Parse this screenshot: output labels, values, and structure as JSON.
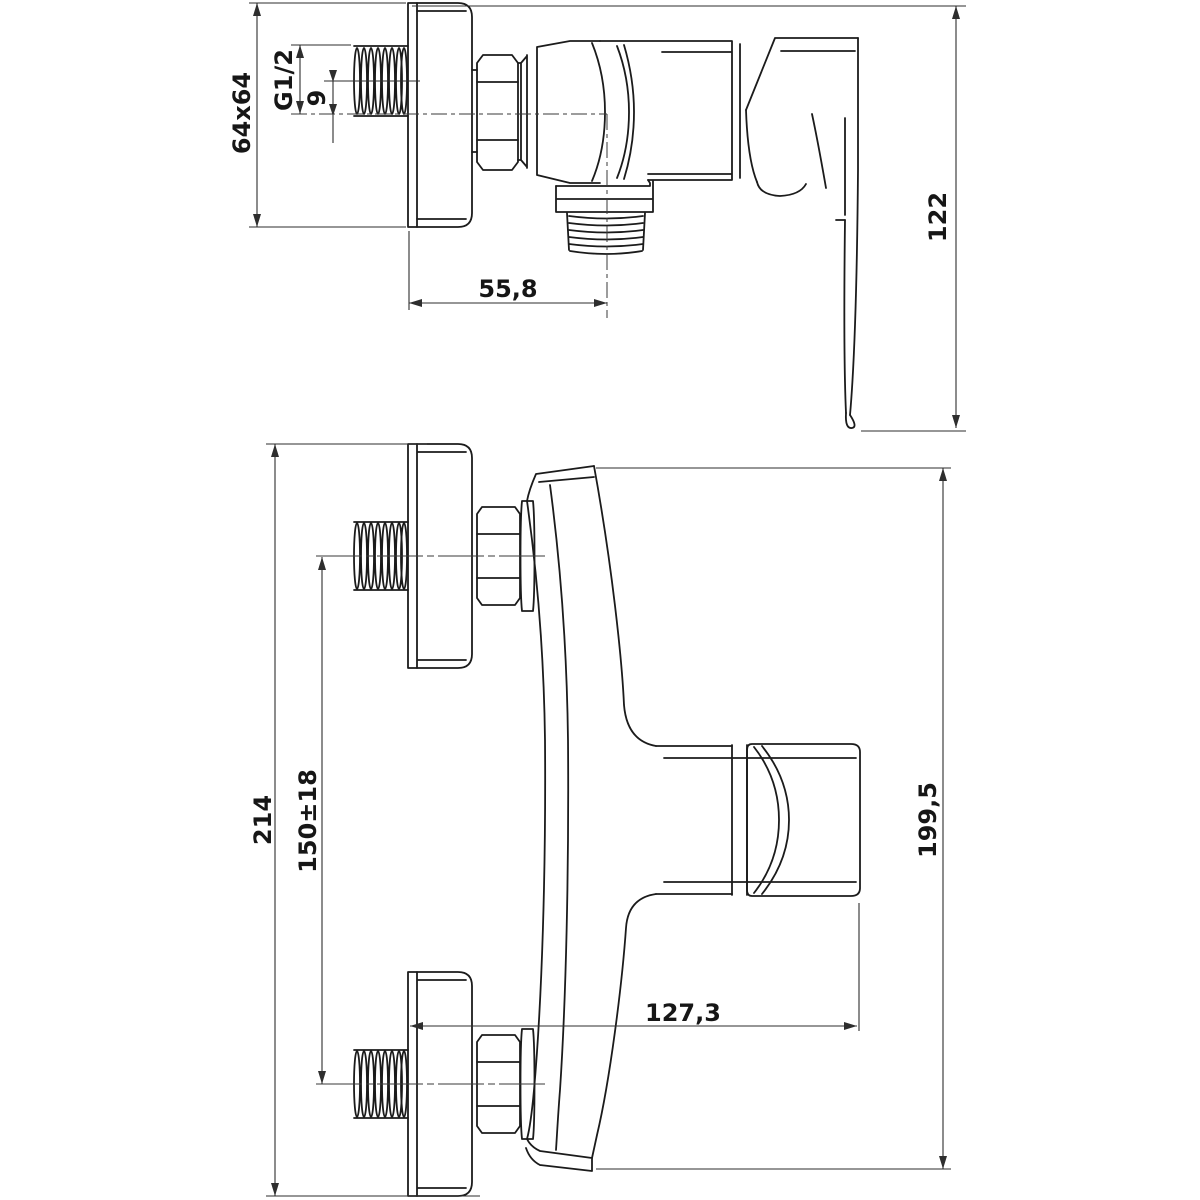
{
  "drawing": {
    "kind": "technical-dimension-drawing",
    "subject": "wall-mounted single-lever shower mixer tap, two orthographic views",
    "colors": {
      "background": "#ffffff",
      "line": "#1b1b1b",
      "dim_line": "#2e2e2e",
      "text": "#161616"
    },
    "views": {
      "side": {
        "name": "side view",
        "dims": {
          "plate": "64x64",
          "thread": "G1/2",
          "offset": "9",
          "outlet": "55,8",
          "height": "122"
        }
      },
      "front": {
        "name": "front view",
        "dims": {
          "span": "214",
          "spacing": "150±18",
          "length": "199,5",
          "reach": "127,3"
        }
      }
    }
  }
}
